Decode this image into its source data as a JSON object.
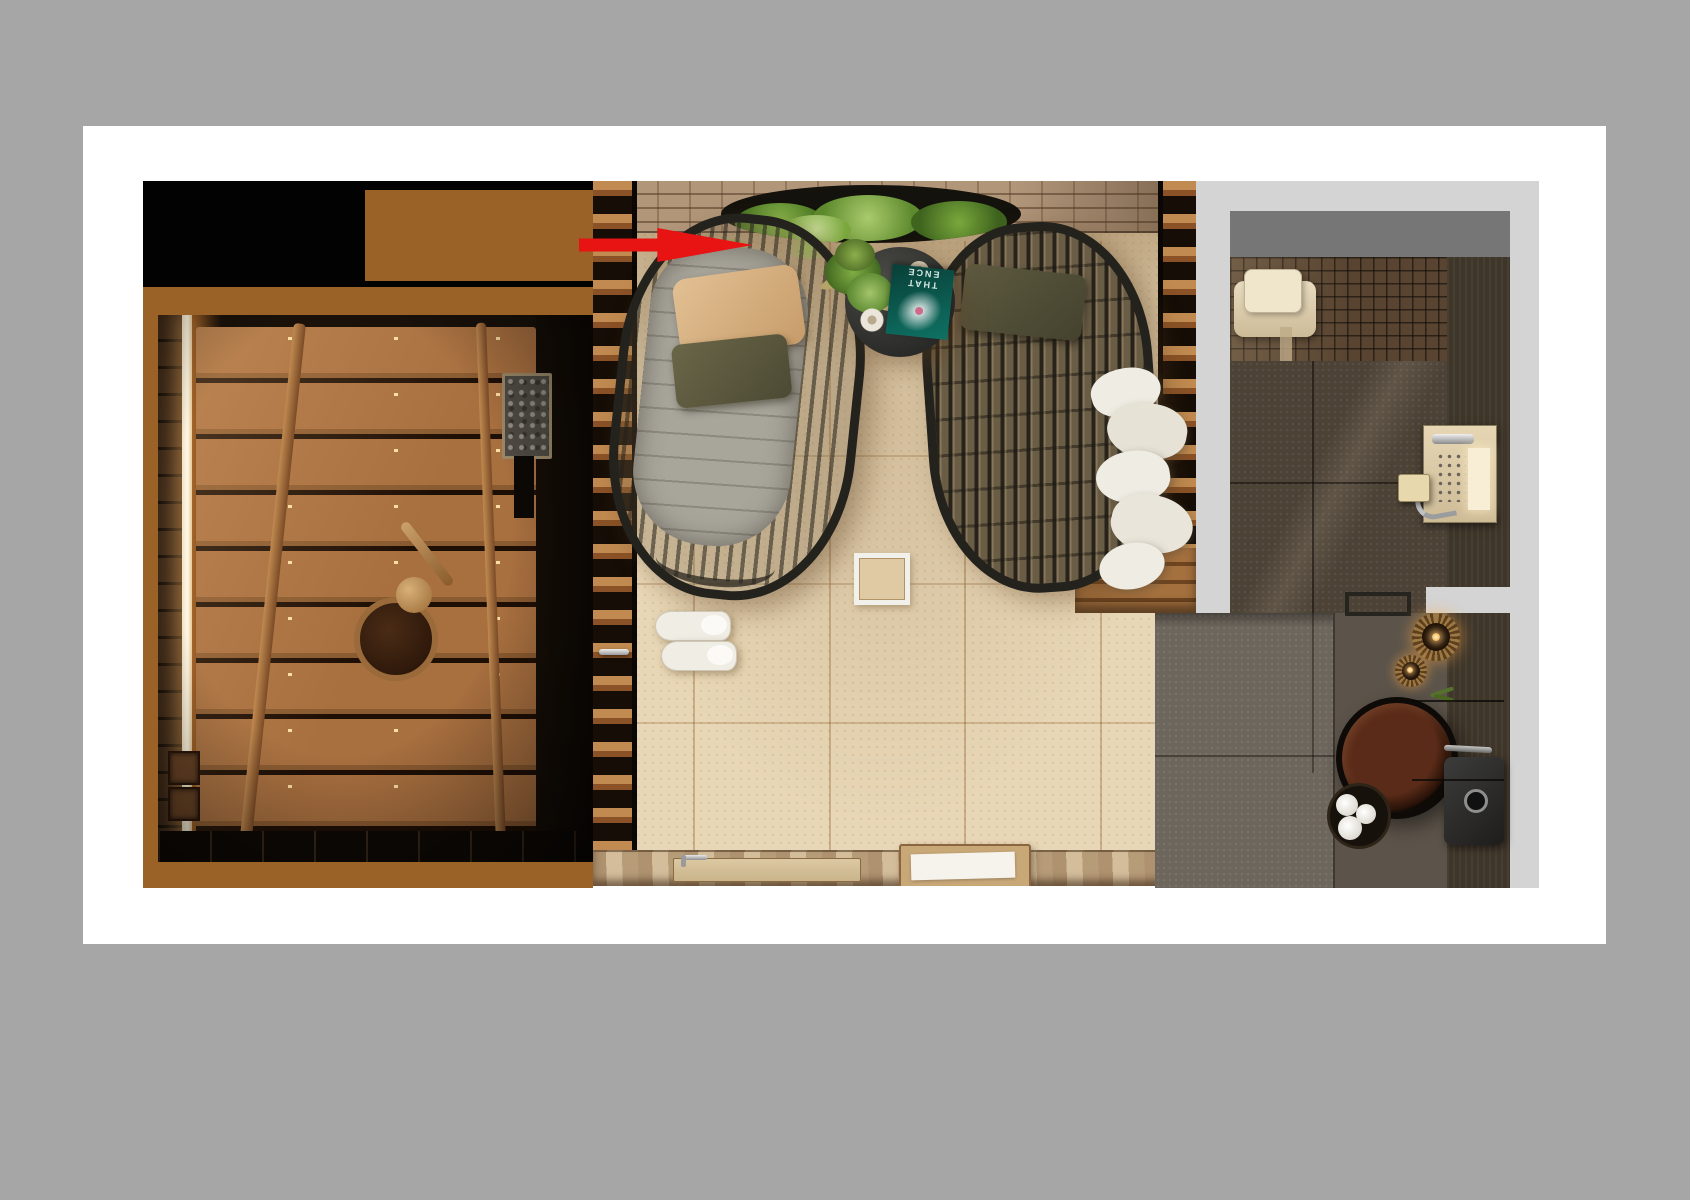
{
  "scene": {
    "type": "3d-interior-render-top-view",
    "title": "Spa suite top view: sauna, relaxation lounge and bathroom",
    "annotation": {
      "shape": "arrow",
      "direction": "right",
      "color": "#e81414",
      "target": "head of the cushioned lounge chair"
    }
  },
  "palette": {
    "background_gray": "#a6a6a6",
    "canvas_white": "#ffffff",
    "mask_black": "#020202",
    "mask_brown": "#9a6226",
    "matte_gray": "#d4d4d4",
    "bath_wall_gray": "#767676",
    "lounge_floor_beige": "#e8d7b6",
    "sauna_wood": "#a86f3f",
    "wicker_frame": "#23221c",
    "magazine_teal": "#0f7264",
    "arrow_red": "#e81414"
  },
  "rooms": {
    "sauna": {
      "label": "Sauna",
      "objects": [
        "backlit LED strip",
        "wood plank bench",
        "ladder rails",
        "sauna heater with stones",
        "wooden bucket",
        "wooden ladle"
      ]
    },
    "lounge": {
      "label": "Relaxation room",
      "objects": [
        "brick wall with recessed hanging planter",
        "round black side table",
        "potted plant",
        "candle",
        "teal magazine",
        "white ring tray",
        "lounge chair with gray quilted cushion",
        "beige pillow",
        "olive pillow",
        "black wicker lounge chair",
        "white spa slippers",
        "white framed floor drain",
        "wood slat partitions",
        "glass door with chrome handle",
        "towels hanging on slat wall",
        "wooden bench",
        "stone ledge with foot-rinse trough and faucet",
        "wooden tray with white towel"
      ]
    },
    "bathroom": {
      "label": "Bathroom",
      "objects": [
        "gray wall band",
        "mosaic tile bench",
        "folded beige towels",
        "dark wood wall",
        "shower control panel",
        "soap shelf",
        "towel bar",
        "large rattan candle holder",
        "small rattan candle holder",
        "round dark soaking tub",
        "chrome handle",
        "basket with rolled white towels",
        "dark sink with chrome drain",
        "green plant sprig",
        "dark stone tile floor"
      ]
    }
  },
  "magazine": {
    "line1": "THAT",
    "line2": "ENCE",
    "orientation": "upside-down"
  }
}
